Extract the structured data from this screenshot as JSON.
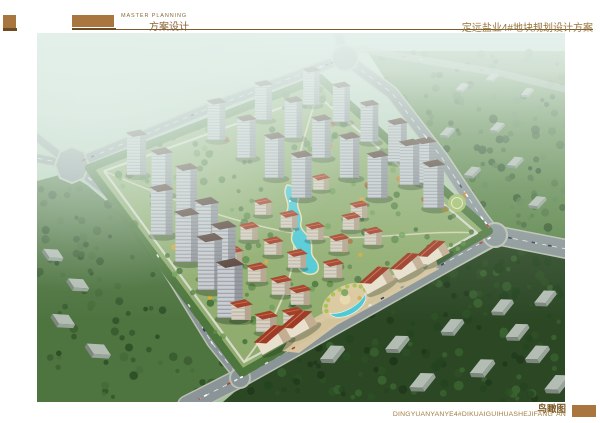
{
  "header": {
    "eyebrow": "MASTER PLANNING",
    "title_cn": "方案设计",
    "project_title": "定远盐业4#地块规划设计方案"
  },
  "footer": {
    "caption_cn": "鸟瞰图",
    "caption_pinyin": "DINGYUANYANYE4#DIKUAIGUIHUASHEJIFANG' AN"
  },
  "rendering": {
    "type": "aerial-birds-eye-render",
    "site_shape": "diamond plot bounded by four roads",
    "features": [
      "high-rise towers",
      "red-roof mid-rise blocks",
      "central turquoise lake",
      "south entrance crescent plaza",
      "perimeter forest",
      "boulevard with traffic"
    ]
  },
  "colors": {
    "accent_brown": "#a8763e",
    "accent_brown_dark": "#6e4b20",
    "heading_text": "#8a6233",
    "project_title_text": "#96743d",
    "caption_text": "#7d5a26",
    "caption_pinyin_text": "#a07a3f",
    "water_turquoise": "#4cc9d6",
    "site_green": "#90ad6f",
    "forest_dark_green": "#2b4724",
    "road_gray": "#8b9597",
    "red_roof": "#a33f28",
    "haze_tint": "#e6f1ec"
  }
}
